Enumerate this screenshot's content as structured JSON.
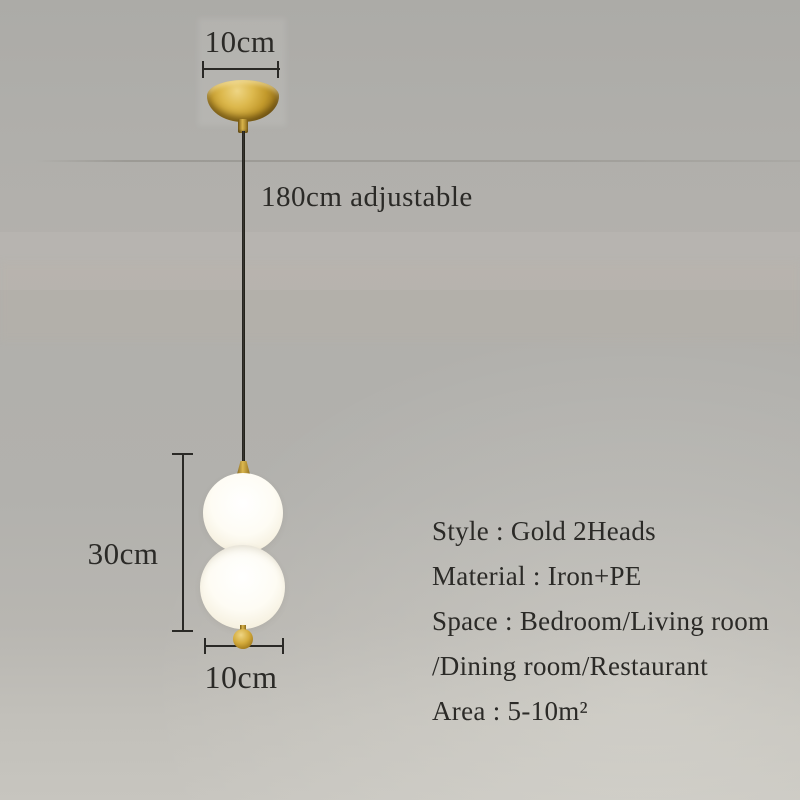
{
  "annotations": {
    "canopy_width": "10cm",
    "cord_length": "180cm adjustable",
    "lamp_height": "30cm",
    "lamp_width": "10cm"
  },
  "specs": {
    "lines": [
      "Style : Gold 2Heads",
      "Material : Iron+PE",
      "Space : Bedroom/Living room",
      "/Dining room/Restaurant",
      "Area : 5-10m²"
    ]
  },
  "colors": {
    "wall_gray": "#b0afab",
    "text": "#2b2a27",
    "brass_gold": "#c89e30",
    "glass_white": "#fdfbf2",
    "cord_black": "#25241f"
  }
}
